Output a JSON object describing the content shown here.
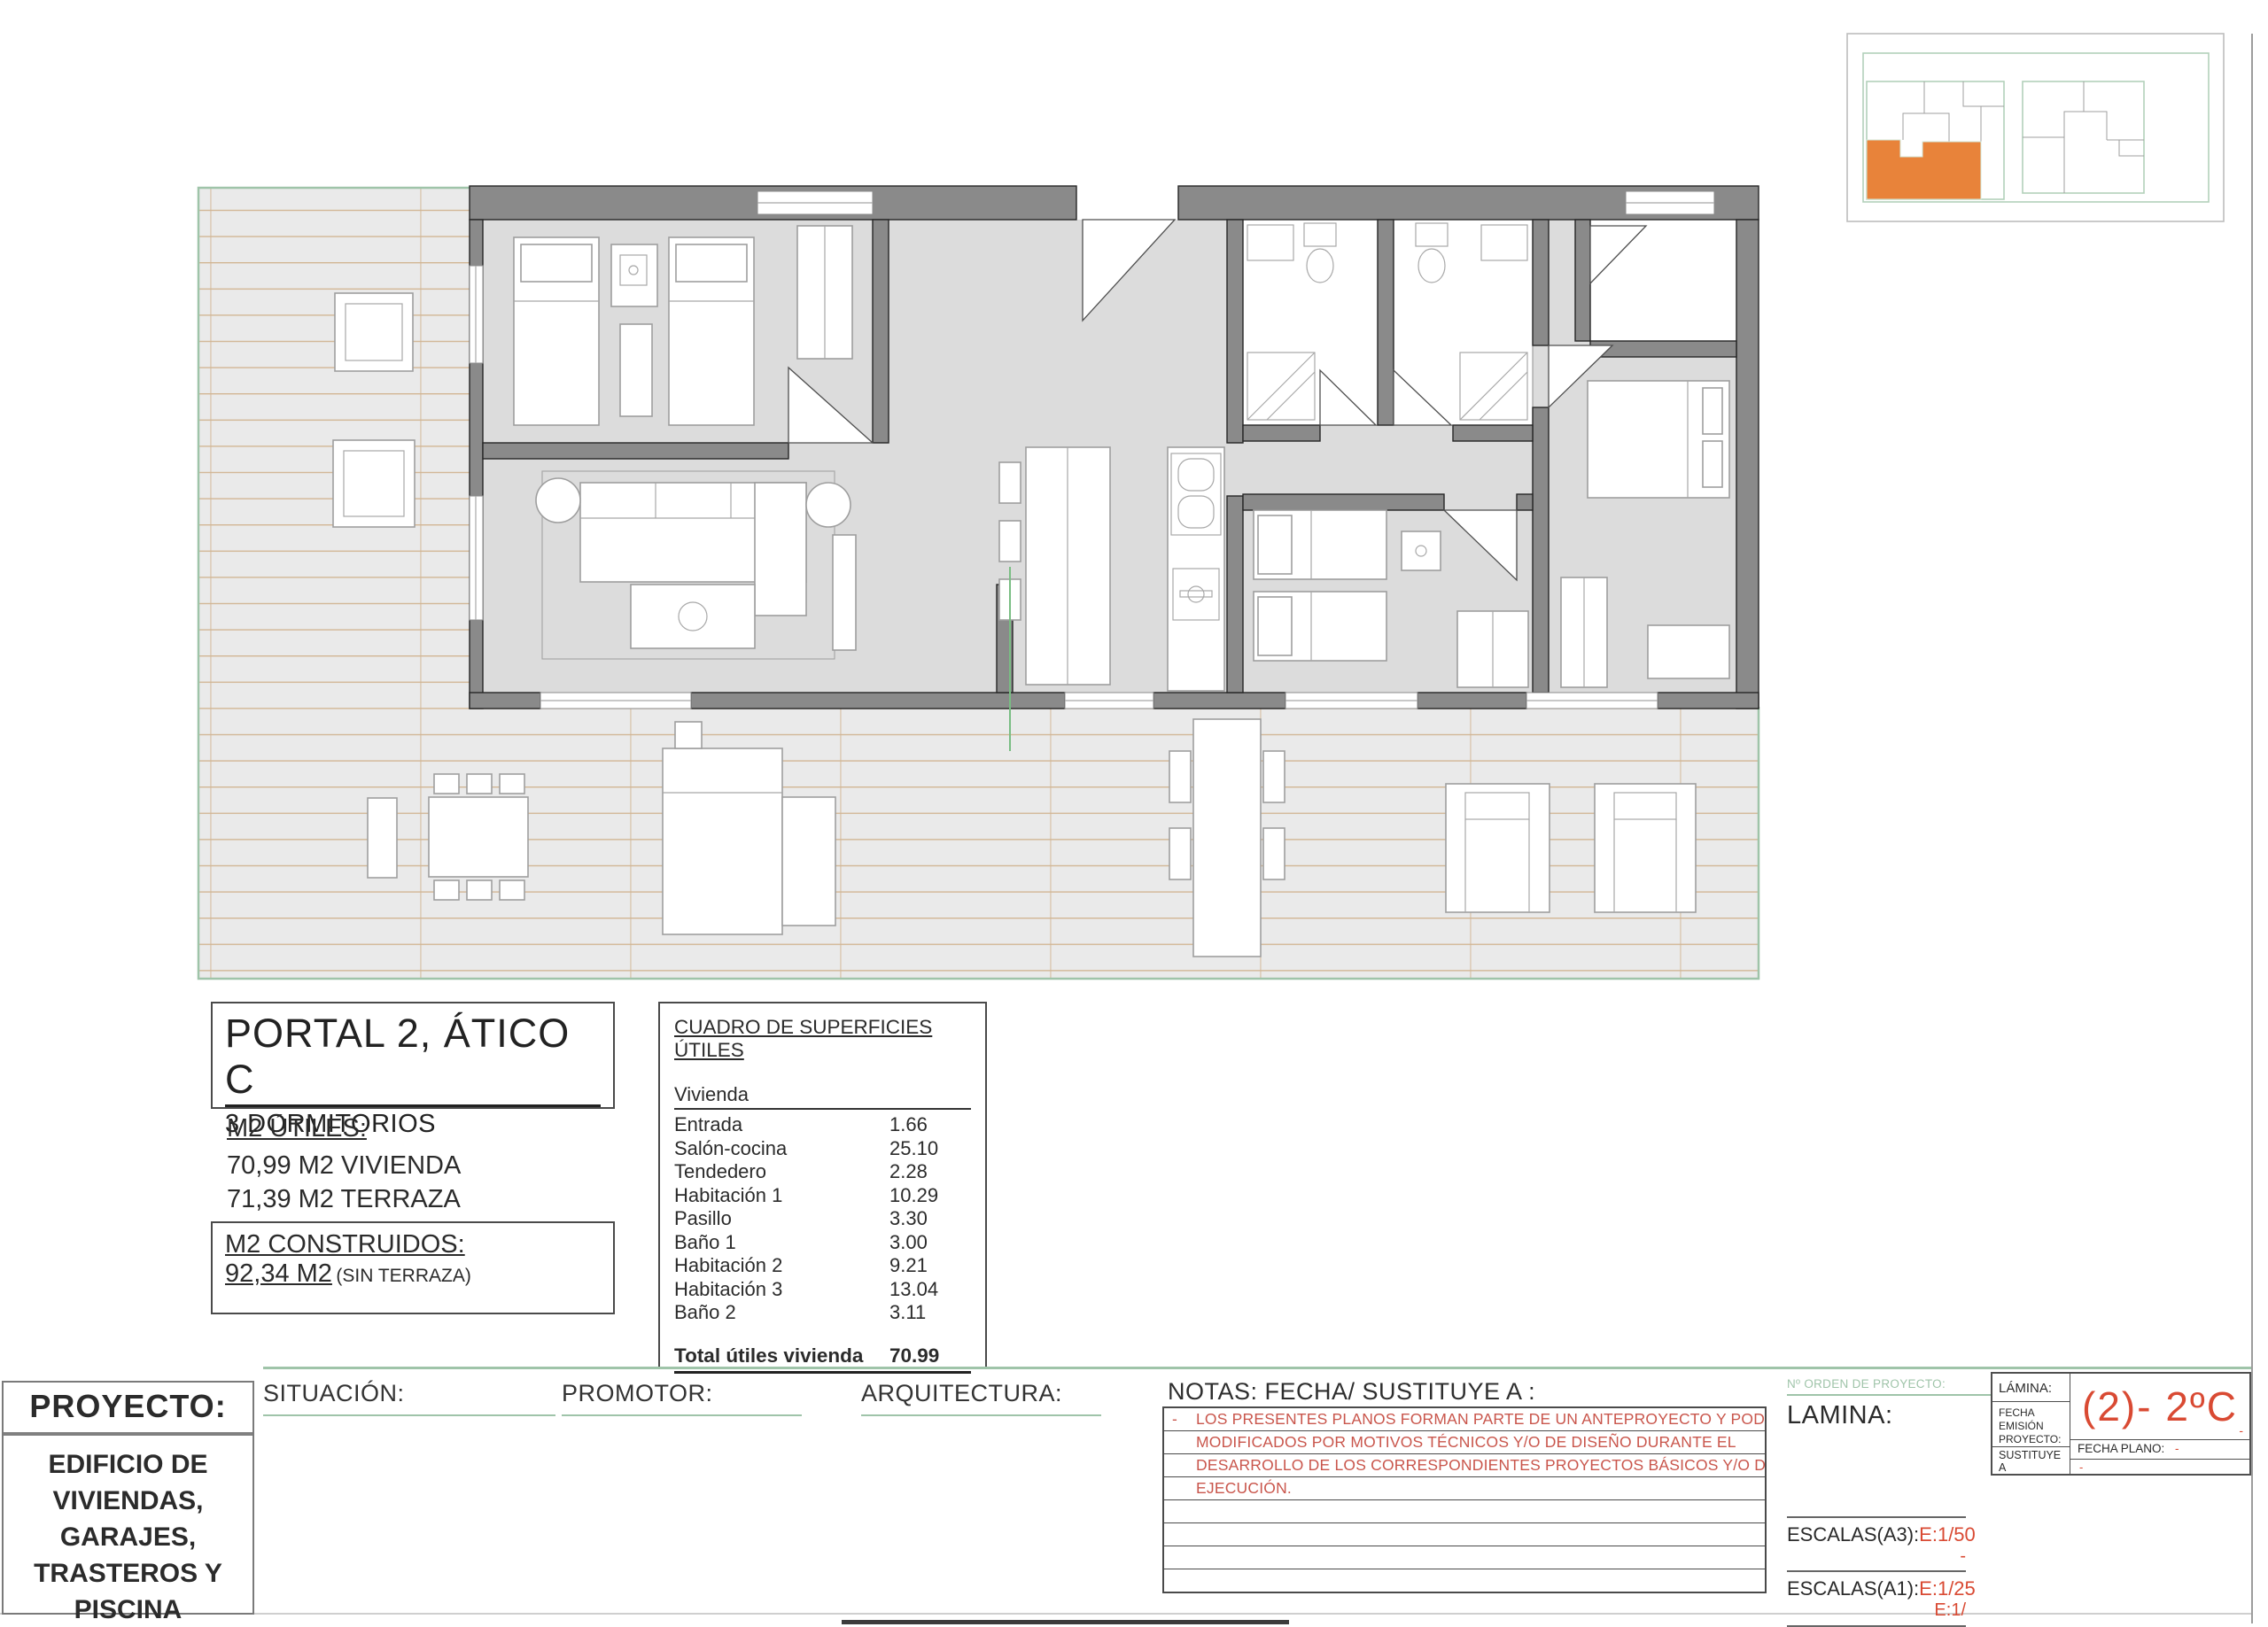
{
  "drawing": {
    "unit_box": {
      "title": "PORTAL 2, ÁTICO C",
      "subtitle": "3 DORMITORIOS"
    },
    "m2_utiles": {
      "label": "M2 ÚTILES:",
      "line1": "70,99 M2 VIVIENDA",
      "line2": "71,39 M2 TERRAZA"
    },
    "m2_construidos": {
      "label": "M2 CONSTRUIDOS:",
      "value": "92,34 M2",
      "note": "(SIN TERRAZA)"
    }
  },
  "surfaces_table": {
    "title": "CUADRO DE SUPERFICIES ÚTILES",
    "group": "Vivienda",
    "rows": [
      {
        "label": "Entrada",
        "value": "1.66"
      },
      {
        "label": "Salón-cocina",
        "value": "25.10"
      },
      {
        "label": "Tendedero",
        "value": "2.28"
      },
      {
        "label": "Habitación 1",
        "value": "10.29"
      },
      {
        "label": "Pasillo",
        "value": "3.30"
      },
      {
        "label": "Baño 1",
        "value": "3.00"
      },
      {
        "label": "Habitación 2",
        "value": "9.21"
      },
      {
        "label": "Habitación 3",
        "value": "13.04"
      },
      {
        "label": "Baño 2",
        "value": "3.11"
      }
    ],
    "total_label": "Total útiles vivienda",
    "total_value": "70.99"
  },
  "title_block": {
    "proyecto_label": "PROYECTO:",
    "proyecto_line1": "EDIFICIO DE",
    "proyecto_line2": "VIVIENDAS,",
    "proyecto_line3": "GARAJES,",
    "proyecto_line4": "TRASTEROS Y",
    "proyecto_line5": "PISCINA",
    "situacion_label": "SITUACIÓN:",
    "promotor_label": "PROMOTOR:",
    "arquitectura_label": "ARQUITECTURA:",
    "notas_label": "NOTAS: FECHA/ SUSTITUYE A :",
    "nota_dash": "-",
    "nota_line1": "LOS PRESENTES PLANOS FORMAN PARTE DE UN ANTEPROYECTO Y PODRÁN SER",
    "nota_line2": "MODIFICADOS  POR MOTIVOS TÉCNICOS Y/O DE DISEÑO DURANTE EL",
    "nota_line3": "DESARROLLO DE LOS CORRESPONDIENTES PROYECTOS BÁSICOS Y/O DE",
    "nota_line4": "EJECUCIÓN.",
    "orden_label": "Nº ORDEN DE PROYECTO:",
    "orden_value": "-",
    "lamina_label": "LAMINA:",
    "escalas_a3_label": "ESCALAS(A3):",
    "escalas_a3_value": "E:1/50",
    "escalas_a3_sub": "-",
    "escalas_a1_label": "ESCALAS(A1):",
    "escalas_a1_value": "E:1/25",
    "escalas_a1_sub": "E:1/"
  },
  "sheet_box": {
    "lamina_label": "LÁMINA:",
    "code": "(2)- 2ºC",
    "code_dash": "-",
    "fecha_emision_label": "FECHA EMISIÓN PROYECTO:",
    "fecha_plano_label": "FECHA PLANO:",
    "fecha_plano_value": "-",
    "sustituye_label": "SUSTITUYE A",
    "sustituye_value": "-"
  },
  "colors": {
    "wall": "#8A8A8A",
    "floor": "#DCDCDC",
    "terrace": "#EAEAEA",
    "tile_line": "#CBA87D",
    "green_line": "#9FC4A9",
    "red_note": "#C9564C",
    "red_accent": "#D94A33",
    "orange": "#E8833A"
  }
}
